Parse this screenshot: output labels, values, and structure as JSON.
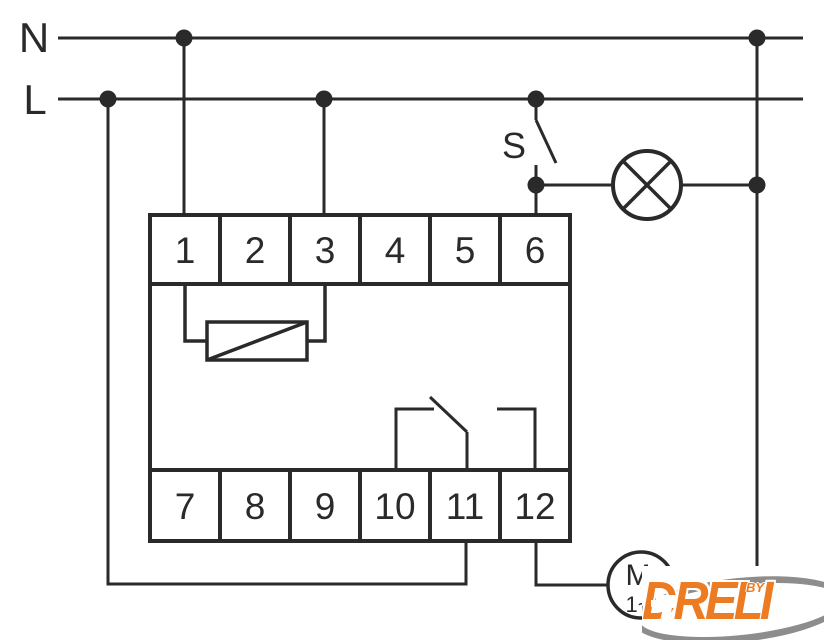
{
  "labels": {
    "neutral": "N",
    "line": "L",
    "switch": "S"
  },
  "device": {
    "top_terminals": [
      "1",
      "2",
      "3",
      "4",
      "5",
      "6"
    ],
    "bottom_terminals": [
      "7",
      "8",
      "9",
      "10",
      "11",
      "12"
    ]
  },
  "motor": {
    "letter": "M",
    "phase": "1~"
  },
  "logo": {
    "brand": "DRELI",
    "by": "BY"
  },
  "colors": {
    "wire": "#2a2a2a",
    "logo_orange": "#ed7b21",
    "logo_gray": "#8e8d8c"
  }
}
